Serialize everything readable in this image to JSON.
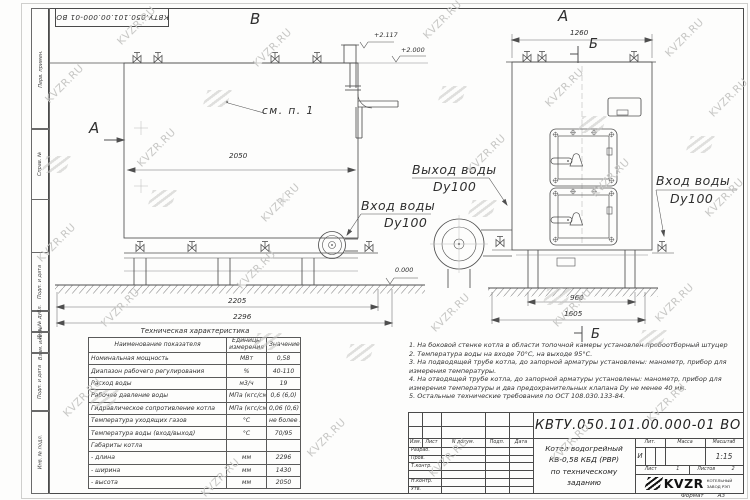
{
  "page": {
    "watermark": "KVZR.RU",
    "format_label": "Формат",
    "format_value": "А3"
  },
  "stamp_top": {
    "number": "КВТУ.050.101.00.000-01 ВО"
  },
  "margin": {
    "s1": "Перв. примен.",
    "s2": "Справ. №",
    "s3": "Подп. и дата",
    "s4": "Инв. № дубл.",
    "s5": "Взам. инв. №",
    "s6": "Подп. и дата",
    "s7": "Инв. № подл."
  },
  "side_view": {
    "section_label": "В",
    "cut_label": "А",
    "see_note": "см. п. 1",
    "elev_217": "+2.117",
    "elev_200": "+2.000",
    "elev_000": "0.000",
    "dim_2050": "2050",
    "dim_2205": "2205",
    "dim_2296": "2296",
    "outlet_line1": "Выход воды",
    "outlet_line2": "Dy100",
    "inlet_line1": "Вход воды",
    "inlet_line2": "Dy100"
  },
  "front_view": {
    "view_label": "А",
    "section_top": "Б",
    "section_bottom": "Б",
    "dim_1260": "1260",
    "dim_960": "960",
    "dim_1605": "1605",
    "inlet_line1": "Вход воды",
    "inlet_line2": "Dy100"
  },
  "spec_table": {
    "title": "Техническая характеристика",
    "col1": "Наименование показателя",
    "col2": "Единицы измерения",
    "col3": "Значение",
    "rows": [
      [
        "Номинальная мощность",
        "МВт",
        "0,58"
      ],
      [
        "Диапазон рабочего регулирования",
        "%",
        "40-110"
      ],
      [
        "Расход воды",
        "м3/ч",
        "19"
      ],
      [
        "Рабочее давление воды",
        "МПа (кгс/см2)",
        "0,6 (6,0)"
      ],
      [
        "Гидравлическое сопротивление котла",
        "МПа (кгс/см2)",
        "0,06 (0,6)"
      ],
      [
        "Температура уходящих газов",
        "°С",
        "не более 280"
      ],
      [
        "Температура воды (вход/выход)",
        "°С",
        "70/95"
      ],
      [
        "Габариты котла",
        "",
        ""
      ],
      [
        "- длина",
        "мм",
        "2296"
      ],
      [
        "- ширина",
        "мм",
        "1430"
      ],
      [
        "- высота",
        "мм",
        "2050"
      ]
    ]
  },
  "notes": [
    "1. На боковой стенке котла в области топочной камеры установлен пробоотборный штуцер",
    "2. Температура воды на входе 70°С, на выходе 95°С.",
    "3. На подводящей трубе котла, до запорной арматуры установлены: манометр, прибор для измерения температуры.",
    "4. На отводящей трубе котла, до запорной арматуры установлены: манометр, прибор для измерения температуры и два предохранительных клапана Dу не менее 40 мм.",
    "5. Остальные технические требования по ОСТ 108.030.133-84."
  ],
  "title_block": {
    "doc_number": "КВТУ.050.101.00.000-01 ВО",
    "col_izm": "Изм.",
    "col_list": "Лист",
    "col_doc": "N докум.",
    "col_podp": "Подп.",
    "col_data": "Дата",
    "row_razrab": "Разраб.",
    "row_prov": "Пров.",
    "row_tkontr": "Т.контр.",
    "row_nkontr": "Н.контр.",
    "row_utv": "Утв.",
    "title_line1": "Котел водогрейный",
    "title_line2": "КВ-0,58 КБД (РВР)",
    "title_line3": "по техническому заданию",
    "lit_label": "Лит.",
    "lit_value": "И",
    "mass_label": "Масса",
    "scale_label": "Масштаб",
    "scale_value": "1:15",
    "sheet_label": "Лист",
    "sheet_value": "1",
    "sheets_label": "Листов",
    "sheets_value": "2",
    "brand": "KVZR",
    "brand_sub1": "КОТЕЛЬНЫЙ",
    "brand_sub2": "ЗАВОД РЭП"
  }
}
